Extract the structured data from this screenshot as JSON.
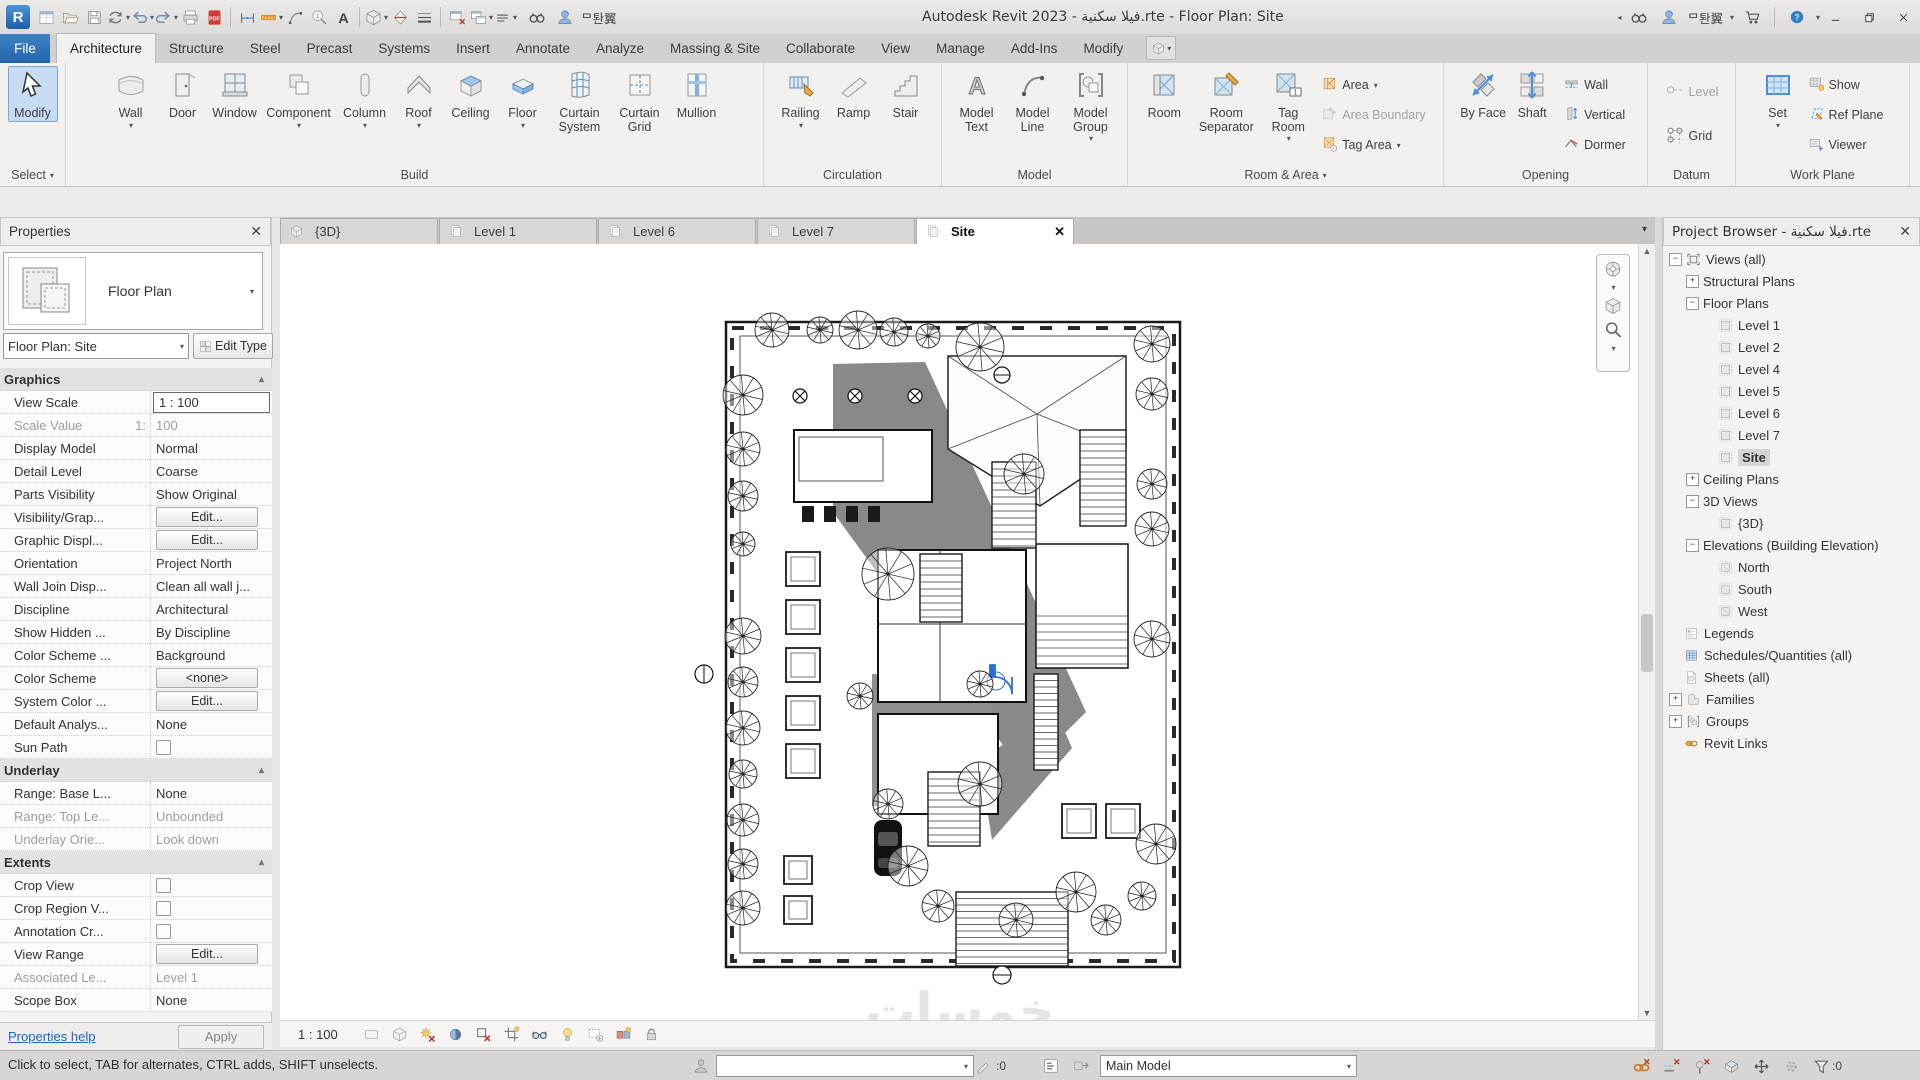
{
  "colors": {
    "accent": "#2F6FC1",
    "file_tab": "#2268B0",
    "selection": "#C6DCF2",
    "pdf_red": "#D23B2F",
    "link_orange": "#E0973C"
  },
  "titlebar": {
    "title": "Autodesk Revit 2023 - فيلا سكنية.rte - Floor Plan: Site",
    "user_name": "ᄆ퇀翼",
    "qat": [
      {
        "id": "revit-logo"
      },
      {
        "id": "properties-palette"
      },
      {
        "id": "open"
      },
      {
        "id": "save"
      },
      {
        "id": "sync",
        "dd": true
      },
      {
        "id": "undo",
        "dd": true
      },
      {
        "id": "redo",
        "dd": true
      },
      {
        "id": "print"
      },
      {
        "id": "export-pdf"
      },
      {
        "sep": true
      },
      {
        "id": "aligned-dimension"
      },
      {
        "id": "measure",
        "dd": true
      },
      {
        "id": "model-line"
      },
      {
        "id": "tag-by-category"
      },
      {
        "id": "text"
      },
      {
        "sep": true
      },
      {
        "id": "default-3d-view",
        "dd": true
      },
      {
        "id": "section"
      },
      {
        "id": "thin-lines"
      },
      {
        "sep": true
      },
      {
        "id": "close-inactive-windows"
      },
      {
        "id": "switch-windows",
        "dd": true
      },
      {
        "id": "customize-qat",
        "dd": true
      }
    ]
  },
  "ribbon": {
    "tabs": [
      {
        "label": "File",
        "file": true
      },
      {
        "label": "Architecture",
        "active": true
      },
      {
        "label": "Structure"
      },
      {
        "label": "Steel"
      },
      {
        "label": "Precast"
      },
      {
        "label": "Systems"
      },
      {
        "label": "Insert"
      },
      {
        "label": "Annotate"
      },
      {
        "label": "Analyze"
      },
      {
        "label": "Massing & Site"
      },
      {
        "label": "Collaborate"
      },
      {
        "label": "View"
      },
      {
        "label": "Manage"
      },
      {
        "label": "Add-Ins"
      },
      {
        "label": "Modify"
      }
    ],
    "panels": [
      {
        "label": "Select",
        "arrow": true,
        "w": 66,
        "items": [
          {
            "t": "big",
            "label": "Modify",
            "icon": "cursor",
            "selected": true
          }
        ]
      },
      {
        "label": "Build",
        "w": 698,
        "items": [
          {
            "t": "big",
            "label": "Wall",
            "icon": "wall",
            "dd": true
          },
          {
            "t": "big",
            "label": "Door",
            "icon": "door"
          },
          {
            "t": "big",
            "label": "Window",
            "icon": "window"
          },
          {
            "t": "big",
            "label": "Component",
            "icon": "component",
            "dd": true,
            "w": 72
          },
          {
            "t": "big",
            "label": "Column",
            "icon": "column",
            "dd": true,
            "w": 52
          },
          {
            "t": "big",
            "label": "Roof",
            "icon": "roof",
            "dd": true
          },
          {
            "t": "big",
            "label": "Ceiling",
            "icon": "ceiling"
          },
          {
            "t": "big",
            "label": "Floor",
            "icon": "floor",
            "dd": true
          },
          {
            "t": "big",
            "label": "Curtain System",
            "icon": "curtain-system",
            "w": 58
          },
          {
            "t": "big",
            "label": "Curtain Grid",
            "icon": "curtain-grid",
            "w": 54
          },
          {
            "t": "big",
            "label": "Mullion",
            "icon": "mullion",
            "w": 52
          }
        ]
      },
      {
        "label": "Circulation",
        "w": 178,
        "items": [
          {
            "t": "big",
            "label": "Railing",
            "icon": "railing",
            "dd": true,
            "w": 50
          },
          {
            "t": "big",
            "label": "Ramp",
            "icon": "ramp"
          },
          {
            "t": "big",
            "label": "Stair",
            "icon": "stair"
          }
        ]
      },
      {
        "label": "Model",
        "w": 186,
        "items": [
          {
            "t": "big",
            "label": "Model Text",
            "icon": "model-text",
            "w": 52
          },
          {
            "t": "big",
            "label": "Model Line",
            "icon": "model-line",
            "w": 52
          },
          {
            "t": "big",
            "label": "Model Group",
            "icon": "model-group",
            "dd": true,
            "w": 56
          }
        ]
      },
      {
        "label": "Room & Area",
        "arrow": true,
        "w": 316,
        "items": [
          {
            "t": "big",
            "label": "Room",
            "icon": "room"
          },
          {
            "t": "big",
            "label": "Room Separator",
            "icon": "room-separator",
            "w": 68
          },
          {
            "t": "big",
            "label": "Tag Room",
            "icon": "tag-room",
            "dd": true,
            "w": 48
          },
          {
            "t": "stack",
            "items": [
              {
                "label": "Area",
                "icon": "area",
                "dd": true
              },
              {
                "label": "Area Boundary",
                "icon": "area-boundary",
                "disabled": true
              },
              {
                "label": "Tag Area",
                "icon": "tag-area",
                "dd": true
              }
            ]
          }
        ]
      },
      {
        "label": "Opening",
        "w": 204,
        "items": [
          {
            "t": "big",
            "label": "By Face",
            "icon": "by-face",
            "w": 46
          },
          {
            "t": "big",
            "label": "Shaft",
            "icon": "shaft",
            "w": 44
          },
          {
            "t": "stack",
            "items": [
              {
                "label": "Wall",
                "icon": "wall-open"
              },
              {
                "label": "Vertical",
                "icon": "vertical-open"
              },
              {
                "label": "Dormer",
                "icon": "dormer"
              }
            ]
          }
        ]
      },
      {
        "label": "Datum",
        "w": 88,
        "items": [
          {
            "t": "stack2",
            "items": [
              {
                "label": "Level",
                "icon": "level",
                "disabled": true
              },
              {
                "label": "Grid",
                "icon": "grid"
              }
            ]
          }
        ]
      },
      {
        "label": "Work Plane",
        "w": 174,
        "items": [
          {
            "t": "big",
            "label": "Set",
            "icon": "set-plane",
            "dd": true,
            "w": 42
          },
          {
            "t": "stack",
            "items": [
              {
                "label": "Show",
                "icon": "show"
              },
              {
                "label": "Ref Plane",
                "icon": "ref-plane"
              },
              {
                "label": "Viewer",
                "icon": "viewer"
              }
            ]
          }
        ]
      }
    ]
  },
  "viewtabs": [
    {
      "label": "{3D}",
      "icon": "view3d"
    },
    {
      "label": "Level 1",
      "icon": "viewdoc"
    },
    {
      "label": "Level 6",
      "icon": "viewdoc"
    },
    {
      "label": "Level 7",
      "icon": "viewdoc"
    },
    {
      "label": "Site",
      "icon": "viewdoc",
      "active": true,
      "close": "✕"
    }
  ],
  "properties": {
    "header": "Properties",
    "type_label": "Floor Plan",
    "selector": "Floor Plan: Site",
    "edit_type": "Edit Type",
    "help": "Properties help",
    "apply": "Apply",
    "rows": [
      {
        "t": "hdr",
        "label": "Graphics"
      },
      {
        "t": "val",
        "label": "View Scale",
        "value": "1 : 100",
        "boxed": true
      },
      {
        "t": "val",
        "label": "Scale Value",
        "label2": "1:",
        "value": "100",
        "disabled": true
      },
      {
        "t": "val",
        "label": "Display Model",
        "value": "Normal"
      },
      {
        "t": "val",
        "label": "Detail Level",
        "value": "Coarse"
      },
      {
        "t": "val",
        "label": "Parts Visibility",
        "value": "Show Original"
      },
      {
        "t": "btn",
        "label": "Visibility/Grap...",
        "value": "Edit..."
      },
      {
        "t": "btn",
        "label": "Graphic Displ...",
        "value": "Edit..."
      },
      {
        "t": "val",
        "label": "Orientation",
        "value": "Project North"
      },
      {
        "t": "val",
        "label": "Wall Join Disp...",
        "value": "Clean all wall j..."
      },
      {
        "t": "val",
        "label": "Discipline",
        "value": "Architectural"
      },
      {
        "t": "val",
        "label": "Show Hidden ...",
        "value": "By Discipline"
      },
      {
        "t": "val",
        "label": "Color Scheme ...",
        "value": "Background"
      },
      {
        "t": "btn",
        "label": "Color Scheme",
        "value": "<none>"
      },
      {
        "t": "btn",
        "label": "System Color ...",
        "value": "Edit..."
      },
      {
        "t": "val",
        "label": "Default Analys...",
        "value": "None"
      },
      {
        "t": "chk",
        "label": "Sun Path",
        "checked": false
      },
      {
        "t": "hdr",
        "label": "Underlay"
      },
      {
        "t": "val",
        "label": "Range: Base L...",
        "value": "None"
      },
      {
        "t": "val",
        "label": "Range: Top Le...",
        "value": "Unbounded",
        "disabled": true
      },
      {
        "t": "val",
        "label": "Underlay Orie...",
        "value": "Look down",
        "disabled": true
      },
      {
        "t": "hdr",
        "label": "Extents"
      },
      {
        "t": "chk",
        "label": "Crop View",
        "checked": false
      },
      {
        "t": "chk",
        "label": "Crop Region V...",
        "checked": false
      },
      {
        "t": "chk",
        "label": "Annotation Cr...",
        "checked": false
      },
      {
        "t": "btn",
        "label": "View Range",
        "value": "Edit..."
      },
      {
        "t": "val",
        "label": "Associated Le...",
        "value": "Level 1",
        "disabled": true
      },
      {
        "t": "val",
        "label": "Scope Box",
        "value": "None"
      }
    ]
  },
  "browser": {
    "header": "Project Browser - فيلا سكنية.rte",
    "items": [
      {
        "d": 0,
        "exp": "-",
        "icon": "views",
        "label": "Views (all)"
      },
      {
        "d": 1,
        "exp": "+",
        "label": "Structural Plans"
      },
      {
        "d": 1,
        "exp": "-",
        "label": "Floor Plans"
      },
      {
        "d": 2,
        "icon": "plan",
        "label": "Level 1"
      },
      {
        "d": 2,
        "icon": "plan",
        "label": "Level 2"
      },
      {
        "d": 2,
        "icon": "plan",
        "label": "Level 4"
      },
      {
        "d": 2,
        "icon": "plan",
        "label": "Level 5"
      },
      {
        "d": 2,
        "icon": "plan",
        "label": "Level 6"
      },
      {
        "d": 2,
        "icon": "plan",
        "label": "Level 7"
      },
      {
        "d": 2,
        "icon": "plan",
        "label": "Site",
        "selected": true
      },
      {
        "d": 1,
        "exp": "+",
        "label": "Ceiling Plans"
      },
      {
        "d": 1,
        "exp": "-",
        "label": "3D Views"
      },
      {
        "d": 2,
        "icon": "plan",
        "label": "{3D}"
      },
      {
        "d": 1,
        "exp": "-",
        "label": "Elevations (Building Elevation)"
      },
      {
        "d": 2,
        "icon": "elev",
        "label": "North"
      },
      {
        "d": 2,
        "icon": "elev",
        "label": "South"
      },
      {
        "d": 2,
        "icon": "elev",
        "label": "West"
      },
      {
        "d": 0,
        "icon": "legend",
        "label": "Legends"
      },
      {
        "d": 0,
        "icon": "schedule",
        "label": "Schedules/Quantities (all)"
      },
      {
        "d": 0,
        "icon": "sheet",
        "label": "Sheets (all)"
      },
      {
        "d": 0,
        "exp": "+",
        "icon": "family",
        "label": "Families"
      },
      {
        "d": 0,
        "exp": "+",
        "icon": "group",
        "label": "Groups"
      },
      {
        "d": 0,
        "icon": "link",
        "label": "Revit Links"
      }
    ]
  },
  "canvas": {
    "watermark": "خمسات"
  },
  "view_control_bar": {
    "scale": "1 : 100",
    "icons": [
      "detail-level",
      "visual-style",
      "sun-path",
      "shadows",
      "crop-view",
      "show-crop-region",
      "temporary-hide-isolate",
      "reveal-hidden-elements",
      "temporary-view-properties",
      "worksharing-display",
      "constraints"
    ]
  },
  "statusbar": {
    "message": "Click to select, TAB for alternates, CTRL adds, SHIFT unselects.",
    "worksets_value": "",
    "editing_requests": ":0",
    "design_option": "Main Model",
    "filter_count": ":0",
    "right_icons": [
      "select-links",
      "select-underlay",
      "select-pinned",
      "select-by-face",
      "drag-on-selection",
      "background-processes"
    ]
  }
}
